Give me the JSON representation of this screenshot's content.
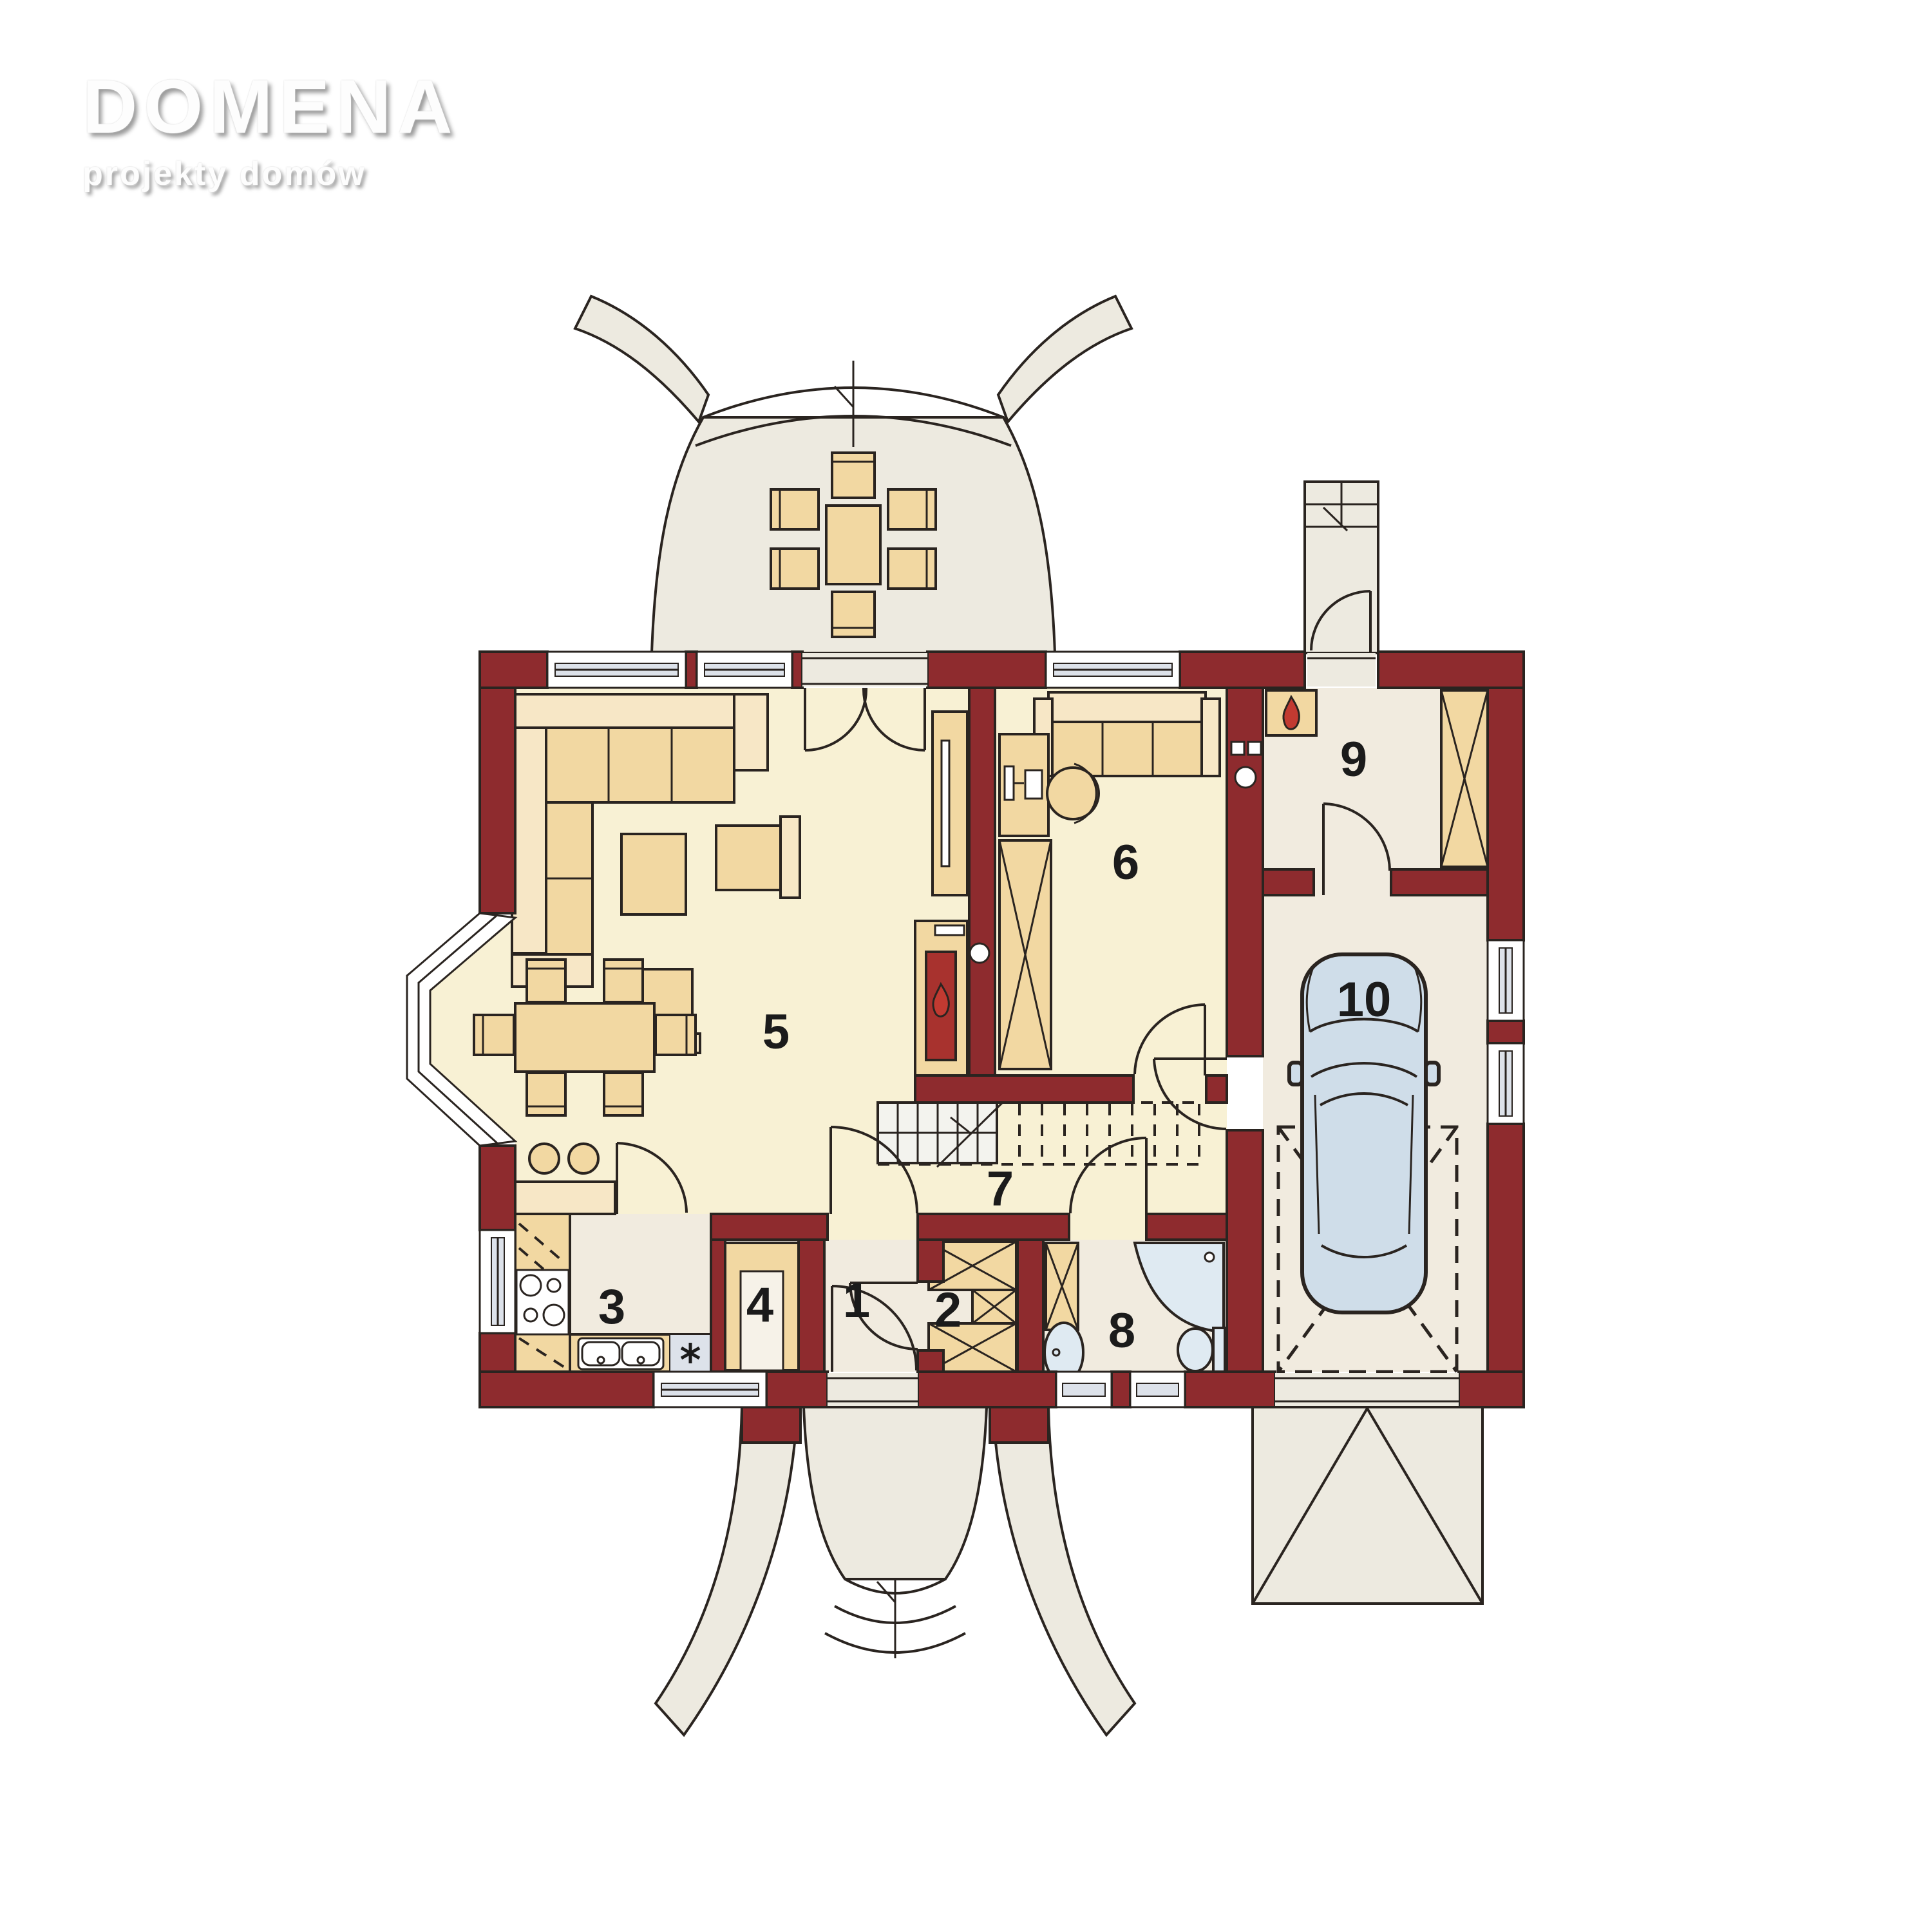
{
  "logo": {
    "title": "DOMENA",
    "subtitle": "projekty domów"
  },
  "rooms": [
    {
      "number": "1"
    },
    {
      "number": "2"
    },
    {
      "number": "3"
    },
    {
      "number": "4"
    },
    {
      "number": "5"
    },
    {
      "number": "6"
    },
    {
      "number": "7"
    },
    {
      "number": "8"
    },
    {
      "number": "9"
    },
    {
      "number": "10"
    }
  ],
  "colors": {
    "wall": "#8e2b2e",
    "outline": "#2a2420",
    "floor_cream": "#f8f1d4",
    "floor_beige": "#f1ebdf",
    "terrace": "#edeae0",
    "furniture": "#f2d8a2",
    "furniture_light": "#f7e7c6",
    "glass": "#dde2ea",
    "fixture": "#dfeaf2",
    "stair": "#f3f3ee",
    "flame": "#c23a31",
    "firebox": "#a8322e",
    "car": "#cfdde9"
  }
}
